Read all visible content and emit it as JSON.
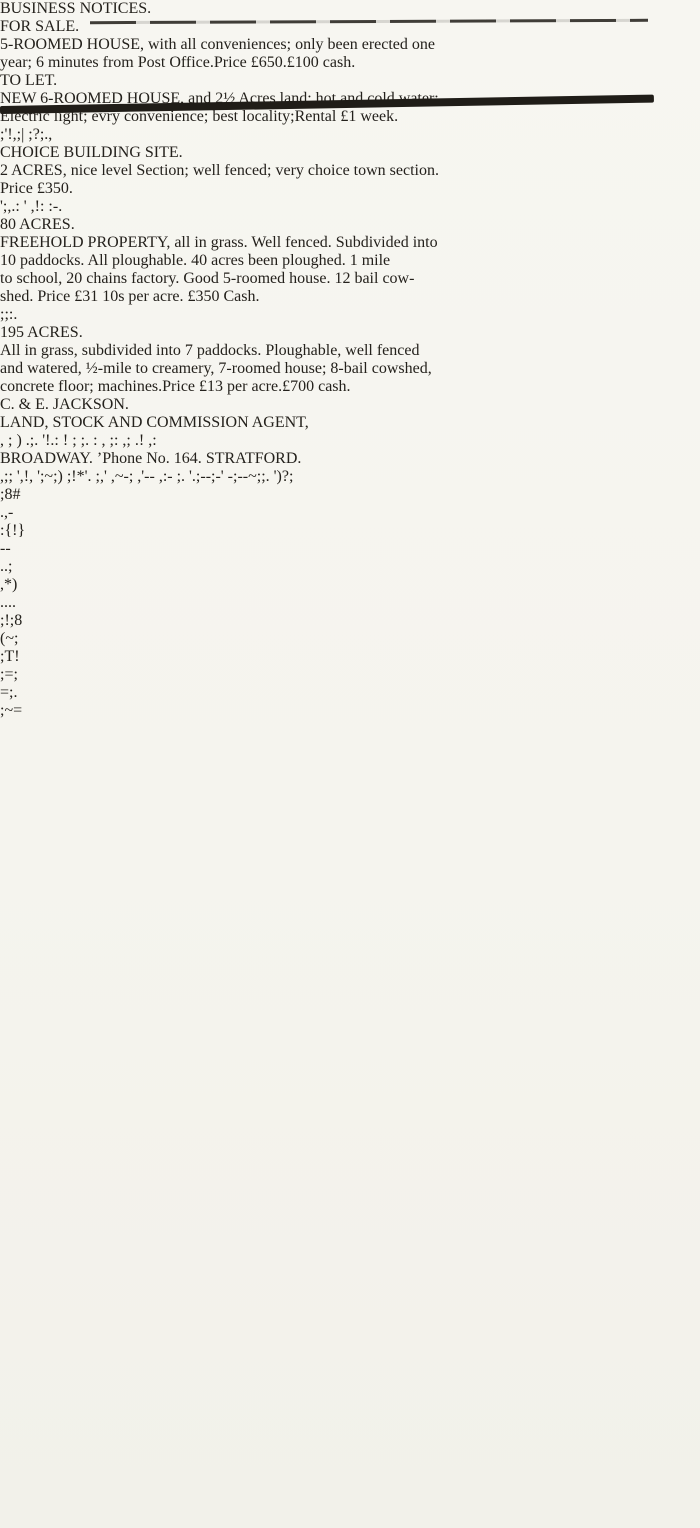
{
  "masthead": {
    "title": "BUSINESS NOTICES."
  },
  "listings": {
    "for_sale": {
      "heading": "FOR SALE.",
      "line1": "5-ROOMED HOUSE, with all conveniences; only been erected one",
      "line2": "year; 6 minutes from Post Office.",
      "price": "Price £650.",
      "terms": "£100 cash."
    },
    "to_let": {
      "heading": "TO LET.",
      "line1": "NEW 6-ROOMED HOUSE, and 2½ Acres land; hot and cold water;",
      "line2": "Electric light; evry convenience; best locality;",
      "rental": "Rental £1 week."
    },
    "building_site": {
      "heading": "CHOICE BUILDING SITE.",
      "line1": "2 ACRES, nice level Section; well fenced; very choice town section.",
      "price": "Price £350."
    },
    "acres_80": {
      "heading": "80 ACRES.",
      "line1": "FREEHOLD PROPERTY, all in grass.  Well fenced.  Subdivided into",
      "line2": "10 paddocks.  All ploughable.  40 acres been ploughed.  1 mile",
      "line3": "to school, 20 chains factory.  Good 5-roomed house.  12 bail cow-",
      "line4": "shed.  Price £31 10s per acre.  £350 Cash."
    },
    "acres_195": {
      "heading": "195 ACRES.",
      "line1": "All in grass, subdivided into 7 paddocks.  Ploughable, well fenced",
      "line2": "and watered, ½-mile to creamery, 7-roomed house; 8-bail cowshed,",
      "line3": "concrete floor; machines.",
      "price": "Price £13 per acre.",
      "terms": "£700 cash."
    }
  },
  "agent": {
    "name": "C. & E. JACKSON.",
    "role": "LAND, STOCK AND COMMISSION AGENT,",
    "address": "BROADWAY.",
    "phone": "’Phone No. 164.",
    "town": "STRATFORD."
  },
  "colors": {
    "ink": "#24211c",
    "paper": "#f6f5f0"
  },
  "artifacts": {
    "margin_fragments": [
      ";8#",
      ".,-",
      ":{!}",
      "--",
      "..;",
      ",*)",
      "....",
      ";!;8",
      "(~;",
      ";T!",
      ";=;",
      "=;.",
      ";~="
    ],
    "ghost_lines": {
      "above_building_site": ";'!,;| ;?;.,",
      "beside_price_350": "';,.: ' ,!: :-.",
      "beside_80_acres": ";;:.",
      "below_agent_role": ", ; )  .;.  '!.: ! ;  ;.  : , ;: ,; .! ,:",
      "below_address_line": ",;; ',!,  ';~;) ;!*'. ;,'  ,~-; ,'--  ,:- ;.  '.;--;-' -;--~;;. ')?;"
    }
  }
}
